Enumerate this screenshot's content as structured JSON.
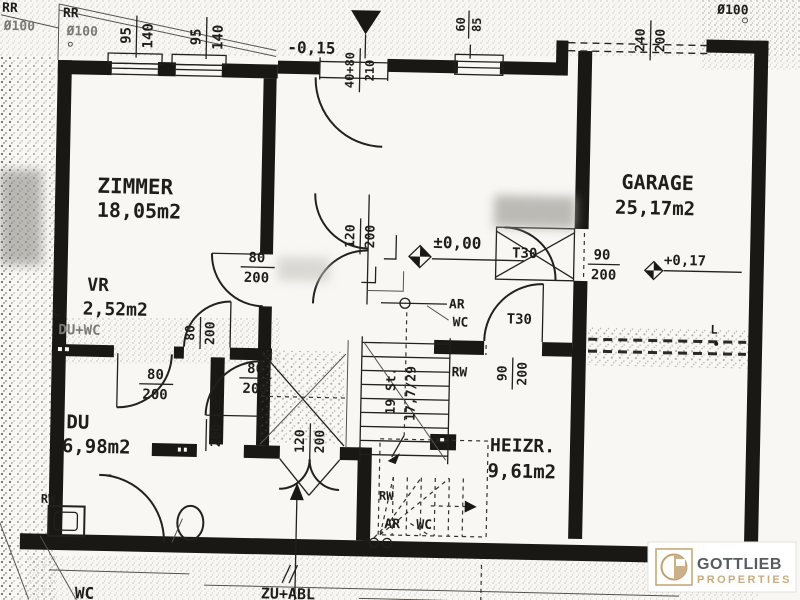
{
  "plan": {
    "rooms": {
      "zimmer": {
        "name": "ZIMMER",
        "area": "18,05m2"
      },
      "vr": {
        "name": "VR",
        "area": "2,52m2"
      },
      "du": {
        "name": "DU",
        "area": "6,98m2"
      },
      "garage": {
        "name": "GARAGE",
        "area": "25,17m2"
      },
      "heizr": {
        "name": "HEIZR.",
        "area": "9,61m2"
      },
      "wc": {
        "name": "WC"
      },
      "du_wc": {
        "name": "DU+WC"
      }
    },
    "levels": {
      "entry": "-0,15",
      "ground": "±0,00",
      "garage": "+0,17"
    },
    "drains": {
      "rr1": {
        "label": "RR",
        "dia": "Ø100"
      },
      "rr2": {
        "label": "RR",
        "dia": "Ø100"
      },
      "roof_right": {
        "dia": "Ø100"
      }
    },
    "windows": {
      "w1": {
        "w": "95",
        "h": "140"
      },
      "w2": {
        "w": "95",
        "h": "140"
      },
      "w3": {
        "w": "60",
        "h": "85"
      }
    },
    "doors": {
      "entry": {
        "w": "40+80",
        "h": "210"
      },
      "garage": {
        "w": "240",
        "h": "200"
      },
      "hall_double": {
        "w": "120",
        "h": "200"
      },
      "wc_double": {
        "w": "120",
        "h": "200"
      },
      "zimmer": {
        "w": "80",
        "h": "200"
      },
      "vr": {
        "w": "80",
        "h": "200"
      },
      "du": {
        "w": "80",
        "h": "200"
      },
      "wc": {
        "w": "80",
        "h": "200"
      },
      "small": {
        "h": "200"
      },
      "garage_fire": {
        "label": "T30",
        "w": "90",
        "h": "200"
      },
      "heizr_fire": {
        "label": "T30",
        "w": "90",
        "h": "200"
      }
    },
    "stairs": {
      "count": "19 St.",
      "rise_run": "17,7/29"
    },
    "vents": {
      "ar1": "AR",
      "wc1": "WC",
      "rw1": "RW",
      "rw2": "RW",
      "rw3": "RW",
      "ar2": "AR",
      "wc2": "WC",
      "zu_abl": "ZU+ABL"
    },
    "marks": {
      "l1": "L",
      "l2": "L"
    }
  },
  "brand": {
    "line1": "GOTTLIEB",
    "line2": "PROPERTIES",
    "gold": "#c2a36e",
    "gray": "#565c60"
  }
}
